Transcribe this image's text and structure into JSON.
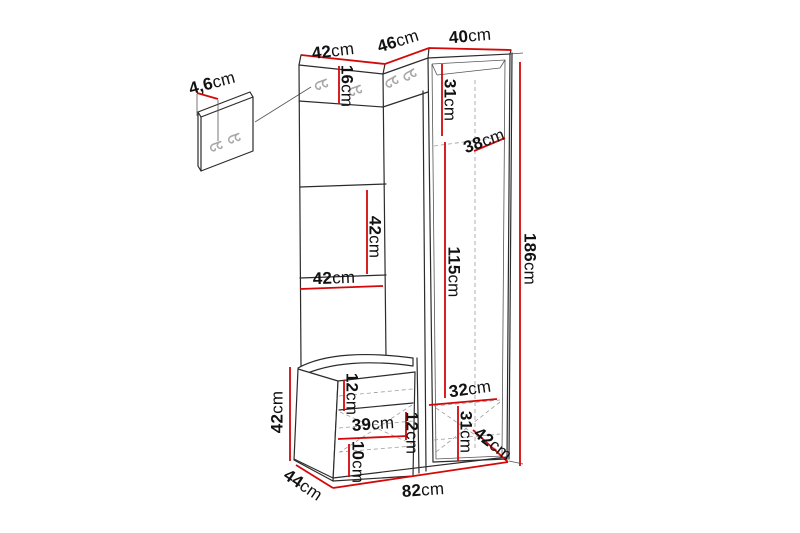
{
  "page": {
    "background": "#ffffff"
  },
  "diagram": {
    "type": "furniture dimension diagram",
    "subject": "hallway wardrobe unit with wall hook panel, coat hook panels, open shelving, seat bench and tall cabinet",
    "colors": {
      "dimension_line": "#d40808",
      "outline": "#2b2b2b",
      "hidden_line": "#9c9c9c",
      "hook_icon": "#a8a8a8",
      "label_text": "#111111",
      "background": "#ffffff"
    },
    "hooks": {
      "icon": "coat-hook-icon",
      "count": 6
    },
    "dimensions": [
      {
        "id": "top-width-left",
        "value": "42",
        "unit": "cm"
      },
      {
        "id": "top-width-middle",
        "value": "46",
        "unit": "cm"
      },
      {
        "id": "top-width-right",
        "value": "40",
        "unit": "cm"
      },
      {
        "id": "wall-panel-depth",
        "value": "4,6",
        "unit": "cm"
      },
      {
        "id": "hook-panel-height",
        "value": "16",
        "unit": "cm"
      },
      {
        "id": "cabinet-upper-interior-height",
        "value": "31",
        "unit": "cm"
      },
      {
        "id": "cabinet-interior-depth",
        "value": "38",
        "unit": "cm"
      },
      {
        "id": "shelf-opening-height",
        "value": "42",
        "unit": "cm"
      },
      {
        "id": "shelf-opening-width",
        "value": "42",
        "unit": "cm"
      },
      {
        "id": "cabinet-interior-height",
        "value": "115",
        "unit": "cm"
      },
      {
        "id": "total-height",
        "value": "186",
        "unit": "cm"
      },
      {
        "id": "cabinet-lower-interior-width",
        "value": "32",
        "unit": "cm"
      },
      {
        "id": "bench-top-clearance",
        "value": "12",
        "unit": "cm"
      },
      {
        "id": "bench-interior-width",
        "value": "39",
        "unit": "cm"
      },
      {
        "id": "bench-shelf-clearance",
        "value": "12",
        "unit": "cm"
      },
      {
        "id": "cabinet-lower-interior-height",
        "value": "31",
        "unit": "cm"
      },
      {
        "id": "bench-bottom-clearance",
        "value": "10",
        "unit": "cm"
      },
      {
        "id": "cabinet-side-depth",
        "value": "42",
        "unit": "cm"
      },
      {
        "id": "bench-height",
        "value": "42",
        "unit": "cm"
      },
      {
        "id": "bench-depth",
        "value": "44",
        "unit": "cm"
      },
      {
        "id": "base-width",
        "value": "82",
        "unit": "cm"
      }
    ]
  }
}
